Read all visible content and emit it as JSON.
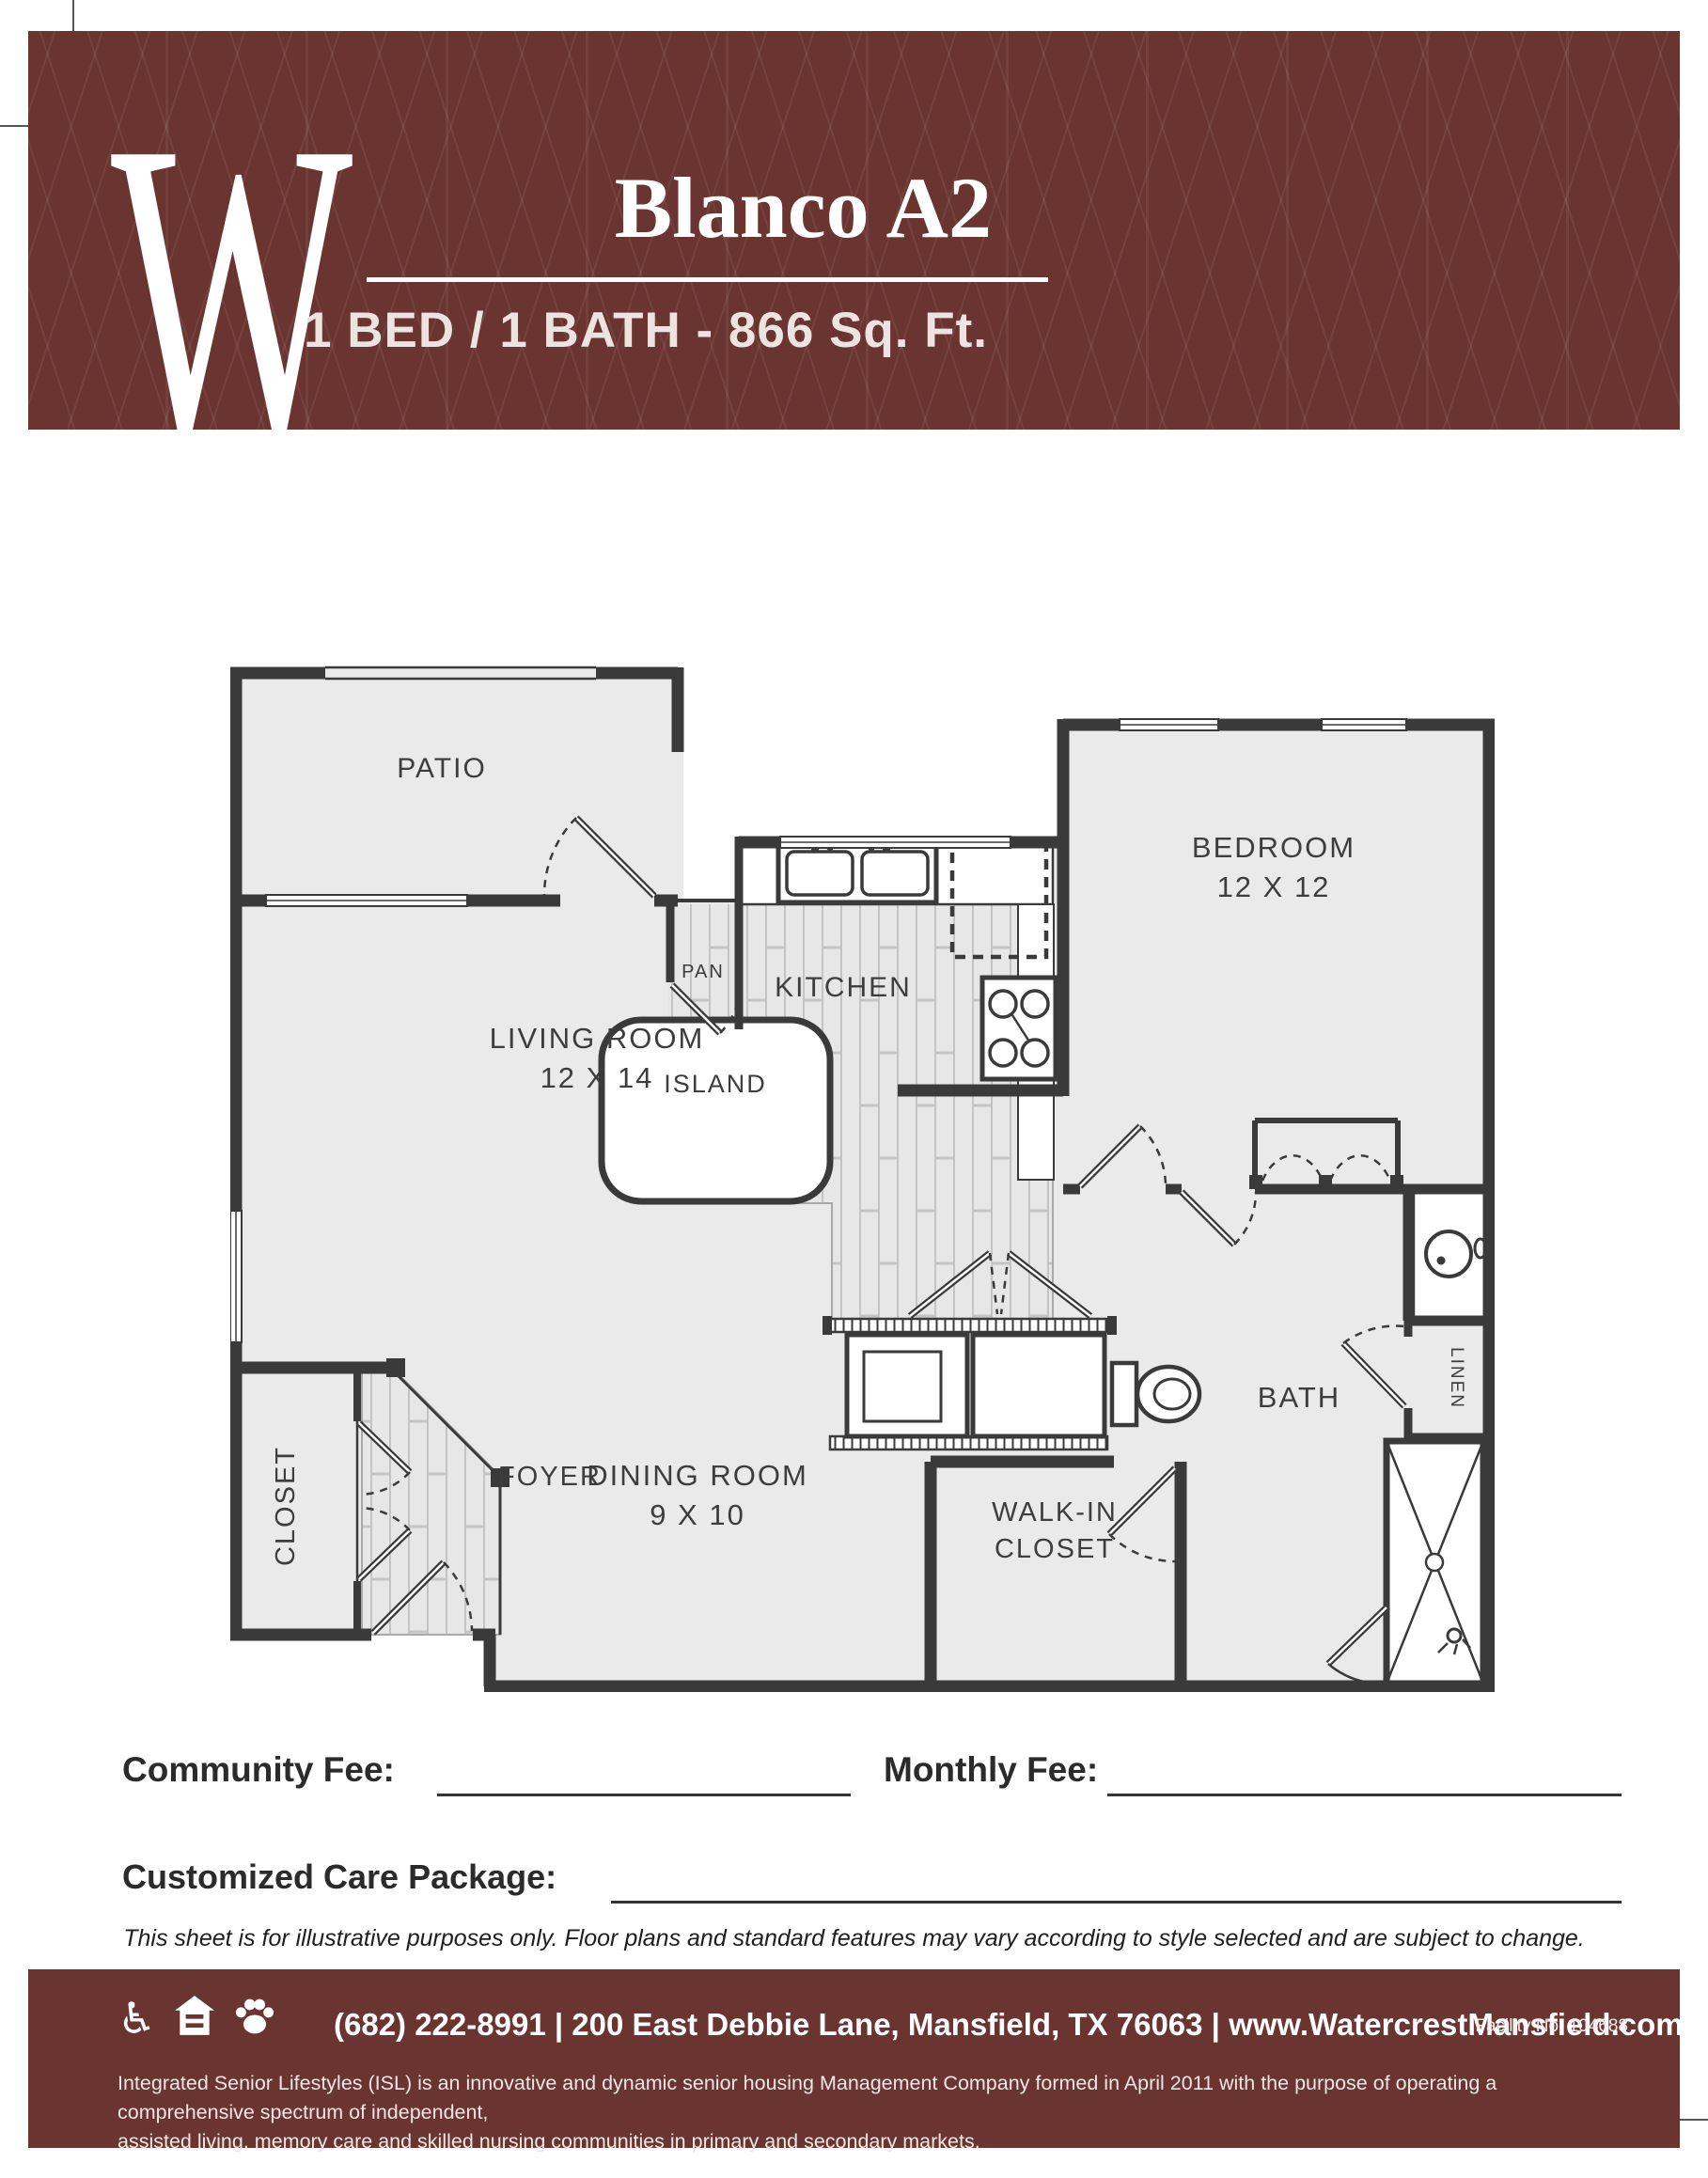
{
  "header": {
    "logo": "W",
    "title": "Blanco A2",
    "subtitle": "1 BED / 1 BATH - 866 Sq. Ft."
  },
  "floorplan": {
    "rooms": {
      "patio": {
        "label": "PATIO"
      },
      "living": {
        "label": "LIVING ROOM",
        "dims": "12 X 14"
      },
      "kitchen": {
        "label": "KITCHEN"
      },
      "island": {
        "label": "ISLAND"
      },
      "pantry": {
        "label": "PAN"
      },
      "bedroom": {
        "label": "BEDROOM",
        "dims": "12 X 12"
      },
      "dining": {
        "label": "DINING ROOM",
        "dims": "9 X 10"
      },
      "walkin": {
        "line1": "WALK-IN",
        "line2": "CLOSET"
      },
      "bath": {
        "label": "BATH"
      },
      "linen": {
        "label": "LINEN"
      },
      "entry_closet": {
        "label": "CLOSET"
      },
      "foyer": {
        "label": "FOYER"
      }
    },
    "fixtures": [
      "kitchen-sink",
      "refrigerator",
      "range",
      "kitchen-island",
      "washer-dryer",
      "toilet",
      "vanity-sink",
      "shower",
      "bedroom-closet-doors",
      "entry-door"
    ]
  },
  "fees": {
    "community_label": "Community Fee:",
    "monthly_label": "Monthly Fee:",
    "care_label": "Customized Care Package:"
  },
  "disclaimer": "This sheet is for illustrative purposes only. Floor plans and standard features may vary according to style selected and are subject to change.",
  "footer": {
    "contact": "(682) 222-8991 | 200 East Debbie Lane, Mansfield, TX 76063 | www.WatercrestMansfield.com",
    "facility": "Facility No. 104688",
    "desc_line1": "Integrated Senior Lifestyles (ISL) is an innovative and dynamic senior housing Management Company formed in April 2011 with the purpose of operating a comprehensive spectrum of independent,",
    "desc_line2": "assisted living, memory care and skilled nursing communities in primary and secondary markets.",
    "icons": [
      "wheelchair-icon",
      "equal-housing-icon",
      "paw-icon"
    ],
    "wheelchair_glyph": "♿"
  },
  "colors": {
    "maroon": "#6A3430",
    "wall": "#3A3A3A",
    "room_fill": "#EAEAEA",
    "wood_fill": "#E7E7E7"
  }
}
